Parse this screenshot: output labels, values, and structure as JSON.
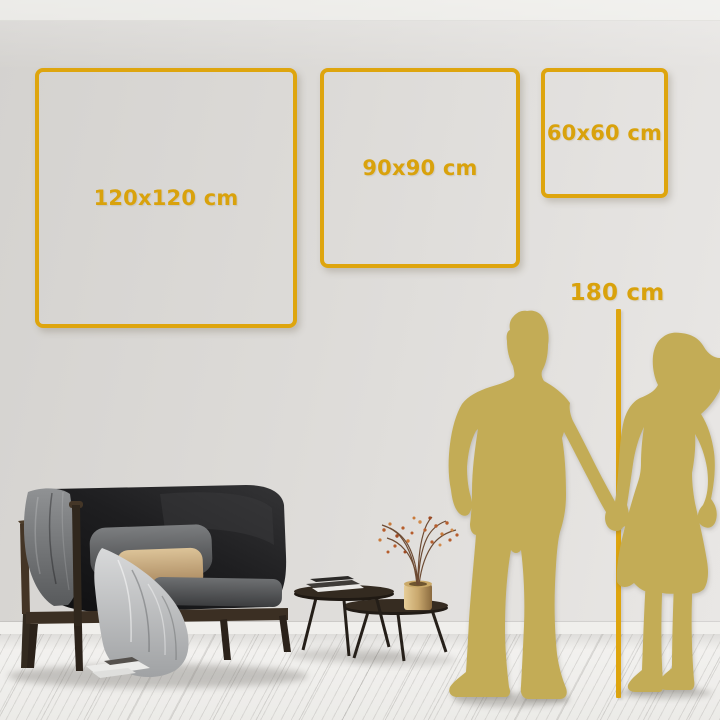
{
  "page": {
    "type": "wall-art-size-guide-visual"
  },
  "palette": {
    "accent_gold": "#DEA50E",
    "label_gold": "#D9A20C",
    "silhouette_gold": "#C3AC56",
    "wall_gray": "#DDDBD8",
    "floor_white": "#F1F0EE"
  },
  "size_frames": [
    {
      "id": "120x120",
      "label": "120x120 cm"
    },
    {
      "id": "90x90",
      "label": "90x90 cm"
    },
    {
      "id": "60x60",
      "label": "60x60 cm"
    }
  ],
  "height_ruler": {
    "label": "180 cm"
  },
  "scene_objects": {
    "sofa": "dark loveseat with wood frame, pillows and draped blankets",
    "coffee_tables": "two nesting round tables with books",
    "vase": "brass vase with dried flowering branches",
    "figures": "man and woman silhouettes holding hands"
  }
}
